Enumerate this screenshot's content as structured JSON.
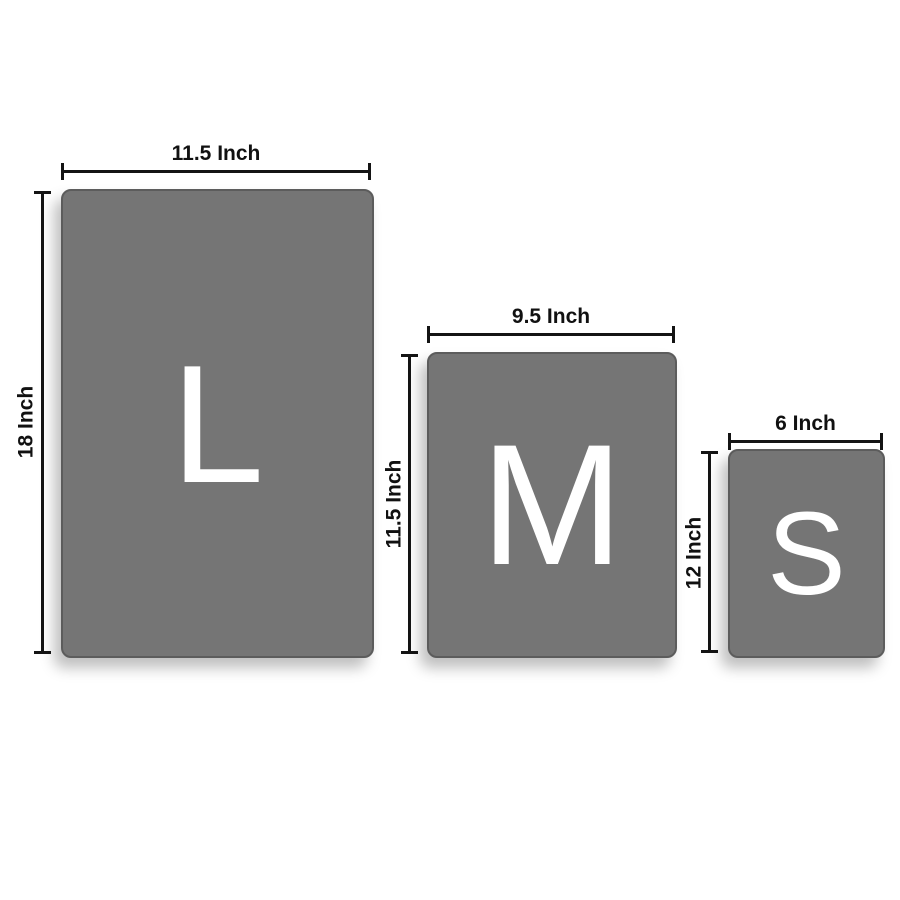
{
  "colors": {
    "background": "#ffffff",
    "card_fill": "#757575",
    "card_border": "#5c5c5c",
    "letter_color": "#ffffff",
    "dimension_color": "#141414"
  },
  "sizes": [
    {
      "id": "large",
      "letter": "L",
      "width_label": "11.5 Inch",
      "height_label": "18 Inch",
      "width_inches": 11.5,
      "height_inches": 18
    },
    {
      "id": "medium",
      "letter": "M",
      "width_label": "9.5 Inch",
      "height_label": "11.5 Inch",
      "width_inches": 9.5,
      "height_inches": 11.5
    },
    {
      "id": "small",
      "letter": "S",
      "width_label": "6 Inch",
      "height_label": "12 Inch",
      "width_inches": 6,
      "height_inches": 12
    }
  ]
}
